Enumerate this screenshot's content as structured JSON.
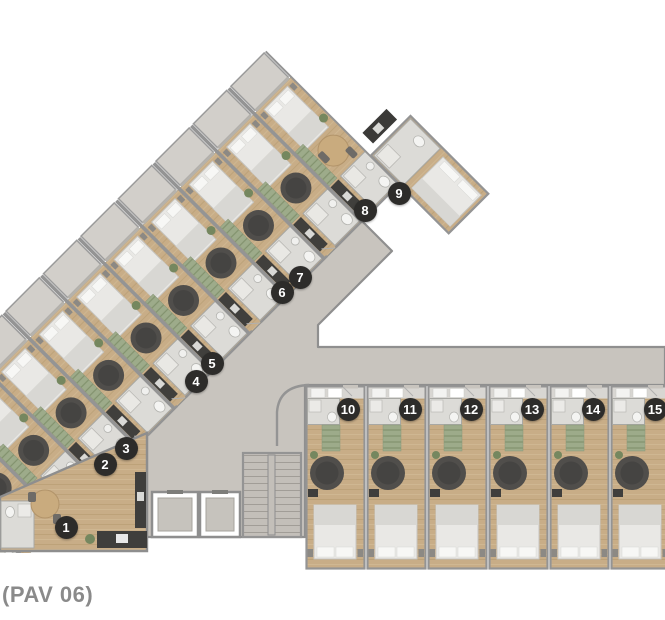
{
  "plan": {
    "title": "(PAV 06)",
    "units": [
      {
        "label": "1",
        "x": 66,
        "y": 527
      },
      {
        "label": "2",
        "x": 105,
        "y": 464
      },
      {
        "label": "3",
        "x": 126,
        "y": 448
      },
      {
        "label": "4",
        "x": 196,
        "y": 381
      },
      {
        "label": "5",
        "x": 212,
        "y": 363
      },
      {
        "label": "6",
        "x": 282,
        "y": 292
      },
      {
        "label": "7",
        "x": 300,
        "y": 277
      },
      {
        "label": "8",
        "x": 365,
        "y": 210
      },
      {
        "label": "9",
        "x": 399,
        "y": 193
      },
      {
        "label": "10",
        "x": 348,
        "y": 409
      },
      {
        "label": "11",
        "x": 410,
        "y": 409
      },
      {
        "label": "12",
        "x": 471,
        "y": 409
      },
      {
        "label": "13",
        "x": 532,
        "y": 409
      },
      {
        "label": "14",
        "x": 593,
        "y": 409
      },
      {
        "label": "15",
        "x": 655,
        "y": 409
      }
    ],
    "colors": {
      "background": "#ffffff",
      "corridor_floor": "#c8c4be",
      "wood_floor": "#c8ad87",
      "bathroom_floor": "#dcdbd7",
      "balcony_floor": "#d2cfca",
      "wall_line": "#949494",
      "badge_background": "#2d2c2a",
      "badge_text": "#ffffff",
      "accent_green": "#9dab8a",
      "furniture_dark": "#504e4b",
      "table_wood": "#c9ab7e",
      "label_text": "#8a8a8a"
    }
  }
}
